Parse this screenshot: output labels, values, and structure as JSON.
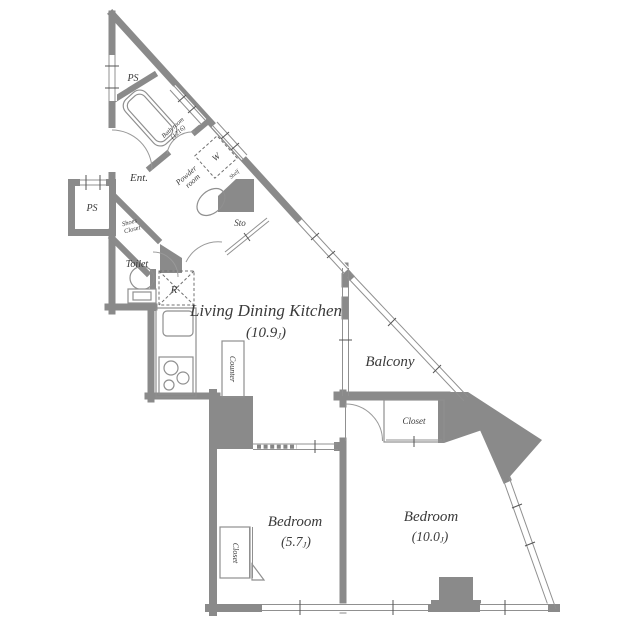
{
  "labels": {
    "ps_top": "PS",
    "ps_left": "PS",
    "bath_1": "Bath room",
    "bath_2": "(1216)",
    "ent": "Ent.",
    "washer": "W",
    "powder_1": "Powder",
    "powder_2": "room",
    "shelf": "Shelf",
    "sto": "Sto",
    "shoes_1": "Shoes",
    "shoes_2": "Closet",
    "toilet": "Toilet",
    "fridge": "R",
    "counter": "Counter",
    "ldk": "Living Dining Kitchen",
    "ldk_size": "(10.9",
    "balcony": "Balcony",
    "closet_b10": "Closet",
    "closet_b57": "Closet",
    "bedroom_57": "Bedroom",
    "b57_size": "(5.7",
    "bedroom_10": "Bedroom",
    "b10_size": "(10.0",
    "unit": "J",
    "close": ")"
  },
  "colors": {
    "wall": "#8a8a8a",
    "outline": "#777777",
    "text": "#3a3a3a",
    "background": "#ffffff"
  }
}
